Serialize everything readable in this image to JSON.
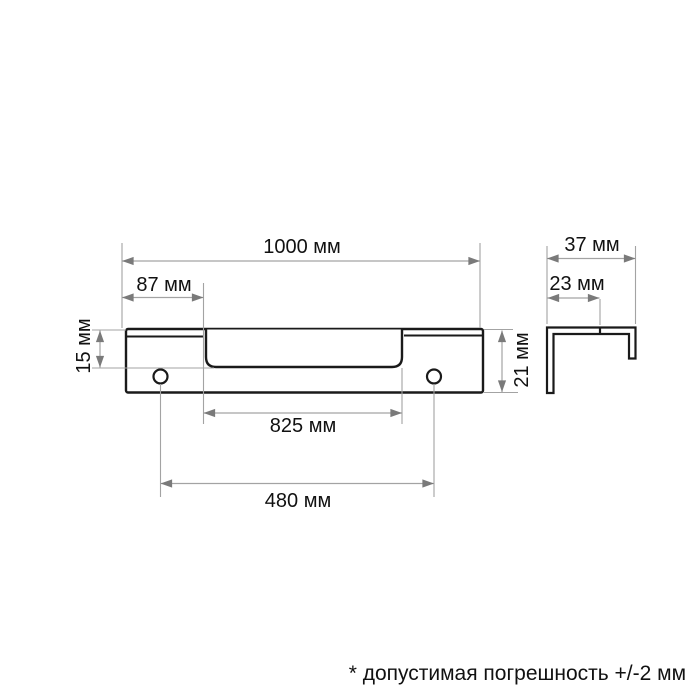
{
  "front_view": {
    "dim_total_length": "1000 мм",
    "dim_end_offset": "87 мм",
    "dim_recess_depth": "15 мм",
    "dim_profile_height": "21 мм",
    "dim_recess_length": "825 мм",
    "dim_hole_spacing": "480 мм"
  },
  "side_view": {
    "dim_profile_width": "37 мм",
    "dim_inner_offset": "23 мм"
  },
  "footnote": "* допустимая погрешность +/-2 мм",
  "colors": {
    "outline": "#1a1a1a",
    "dimension_line": "#a3a3a3",
    "arrowhead": "#7a7a7a",
    "text": "#111111",
    "background": "#ffffff"
  }
}
